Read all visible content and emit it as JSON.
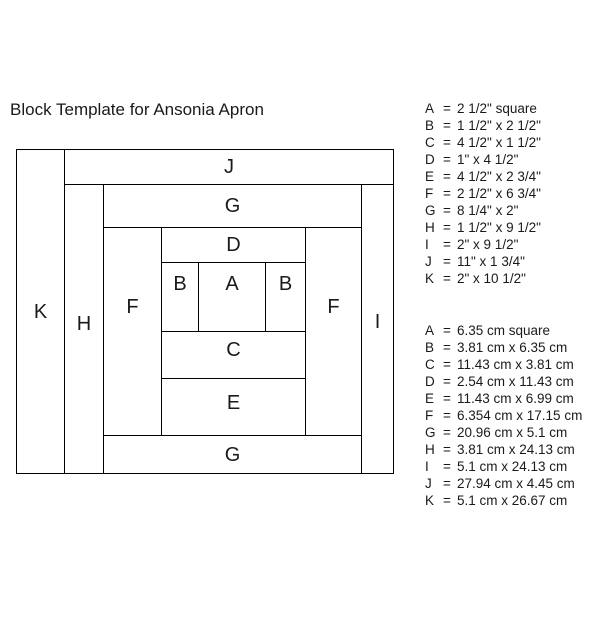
{
  "title": "Block Template for Ansonia Apron",
  "pieces": {
    "A": "A",
    "B": "B",
    "C": "C",
    "D": "D",
    "E": "E",
    "F": "F",
    "G": "G",
    "H": "H",
    "I": "I",
    "J": "J",
    "K": "K"
  },
  "legend": {
    "eq": "=",
    "inches": [
      {
        "k": "A",
        "v": "2 1/2\" square"
      },
      {
        "k": "B",
        "v": "1 1/2\" x 2 1/2\""
      },
      {
        "k": "C",
        "v": "4 1/2\" x 1 1/2\""
      },
      {
        "k": "D",
        "v": "1\" x 4 1/2\""
      },
      {
        "k": "E",
        "v": "4 1/2\" x 2 3/4\""
      },
      {
        "k": "F",
        "v": "2 1/2\" x 6 3/4\""
      },
      {
        "k": "G",
        "v": "8 1/4\" x 2\""
      },
      {
        "k": "H",
        "v": "1 1/2\" x 9 1/2\""
      },
      {
        "k": "I",
        "v": "2\" x 9 1/2\""
      },
      {
        "k": "J",
        "v": "11\" x 1 3/4\""
      },
      {
        "k": "K",
        "v": "2\" x 10 1/2\""
      }
    ],
    "cm": [
      {
        "k": "A",
        "v": "6.35 cm square"
      },
      {
        "k": "B",
        "v": "3.81 cm x 6.35 cm"
      },
      {
        "k": "C",
        "v": "11.43 cm x 3.81 cm"
      },
      {
        "k": "D",
        "v": "2.54 cm x 11.43 cm"
      },
      {
        "k": "E",
        "v": "11.43 cm x 6.99 cm"
      },
      {
        "k": "F",
        "v": "6.354 cm x 17.15 cm"
      },
      {
        "k": "G",
        "v": "20.96 cm x 5.1 cm"
      },
      {
        "k": "H",
        "v": "3.81 cm x 24.13 cm"
      },
      {
        "k": "I",
        "v": "5.1 cm x 24.13 cm"
      },
      {
        "k": "J",
        "v": "27.94 cm x 4.45 cm"
      },
      {
        "k": "K",
        "v": "5.1 cm x 26.67 cm"
      }
    ]
  }
}
